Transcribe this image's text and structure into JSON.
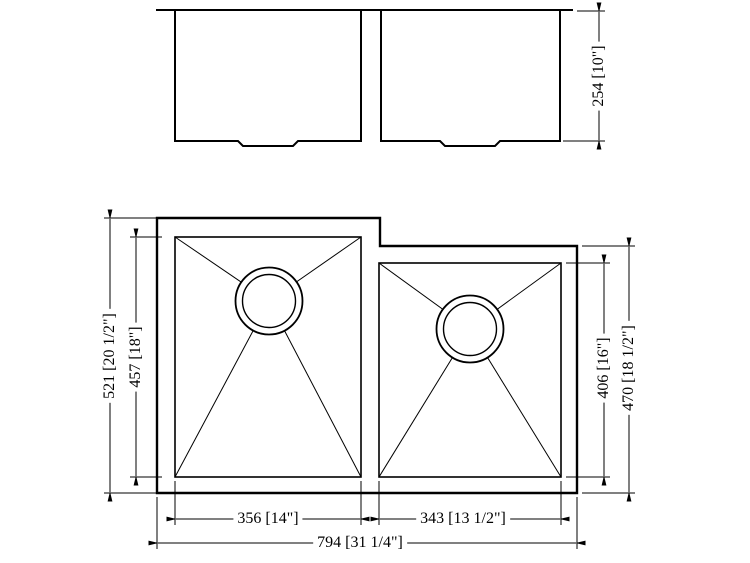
{
  "page": {
    "background": "#ffffff",
    "line_color": "#000000",
    "description": "Technical dimension drawing of a double-bowl undermount sink, front elevation and plan view"
  },
  "views": {
    "front": {
      "dims": {
        "depth": "254 [10\"]"
      }
    },
    "plan": {
      "dims": {
        "overall_height": "521 [20 1/2\"]",
        "left_bowl_depth": "457 [18\"]",
        "right_bowl_depth": "406 [16\"]",
        "right_overall_height": "470 [18 1/2\"]",
        "left_bowl_width": "356 [14\"]",
        "right_bowl_width": "343 [13 1/2\"]",
        "overall_width": "794 [31 1/4\"]"
      }
    }
  }
}
